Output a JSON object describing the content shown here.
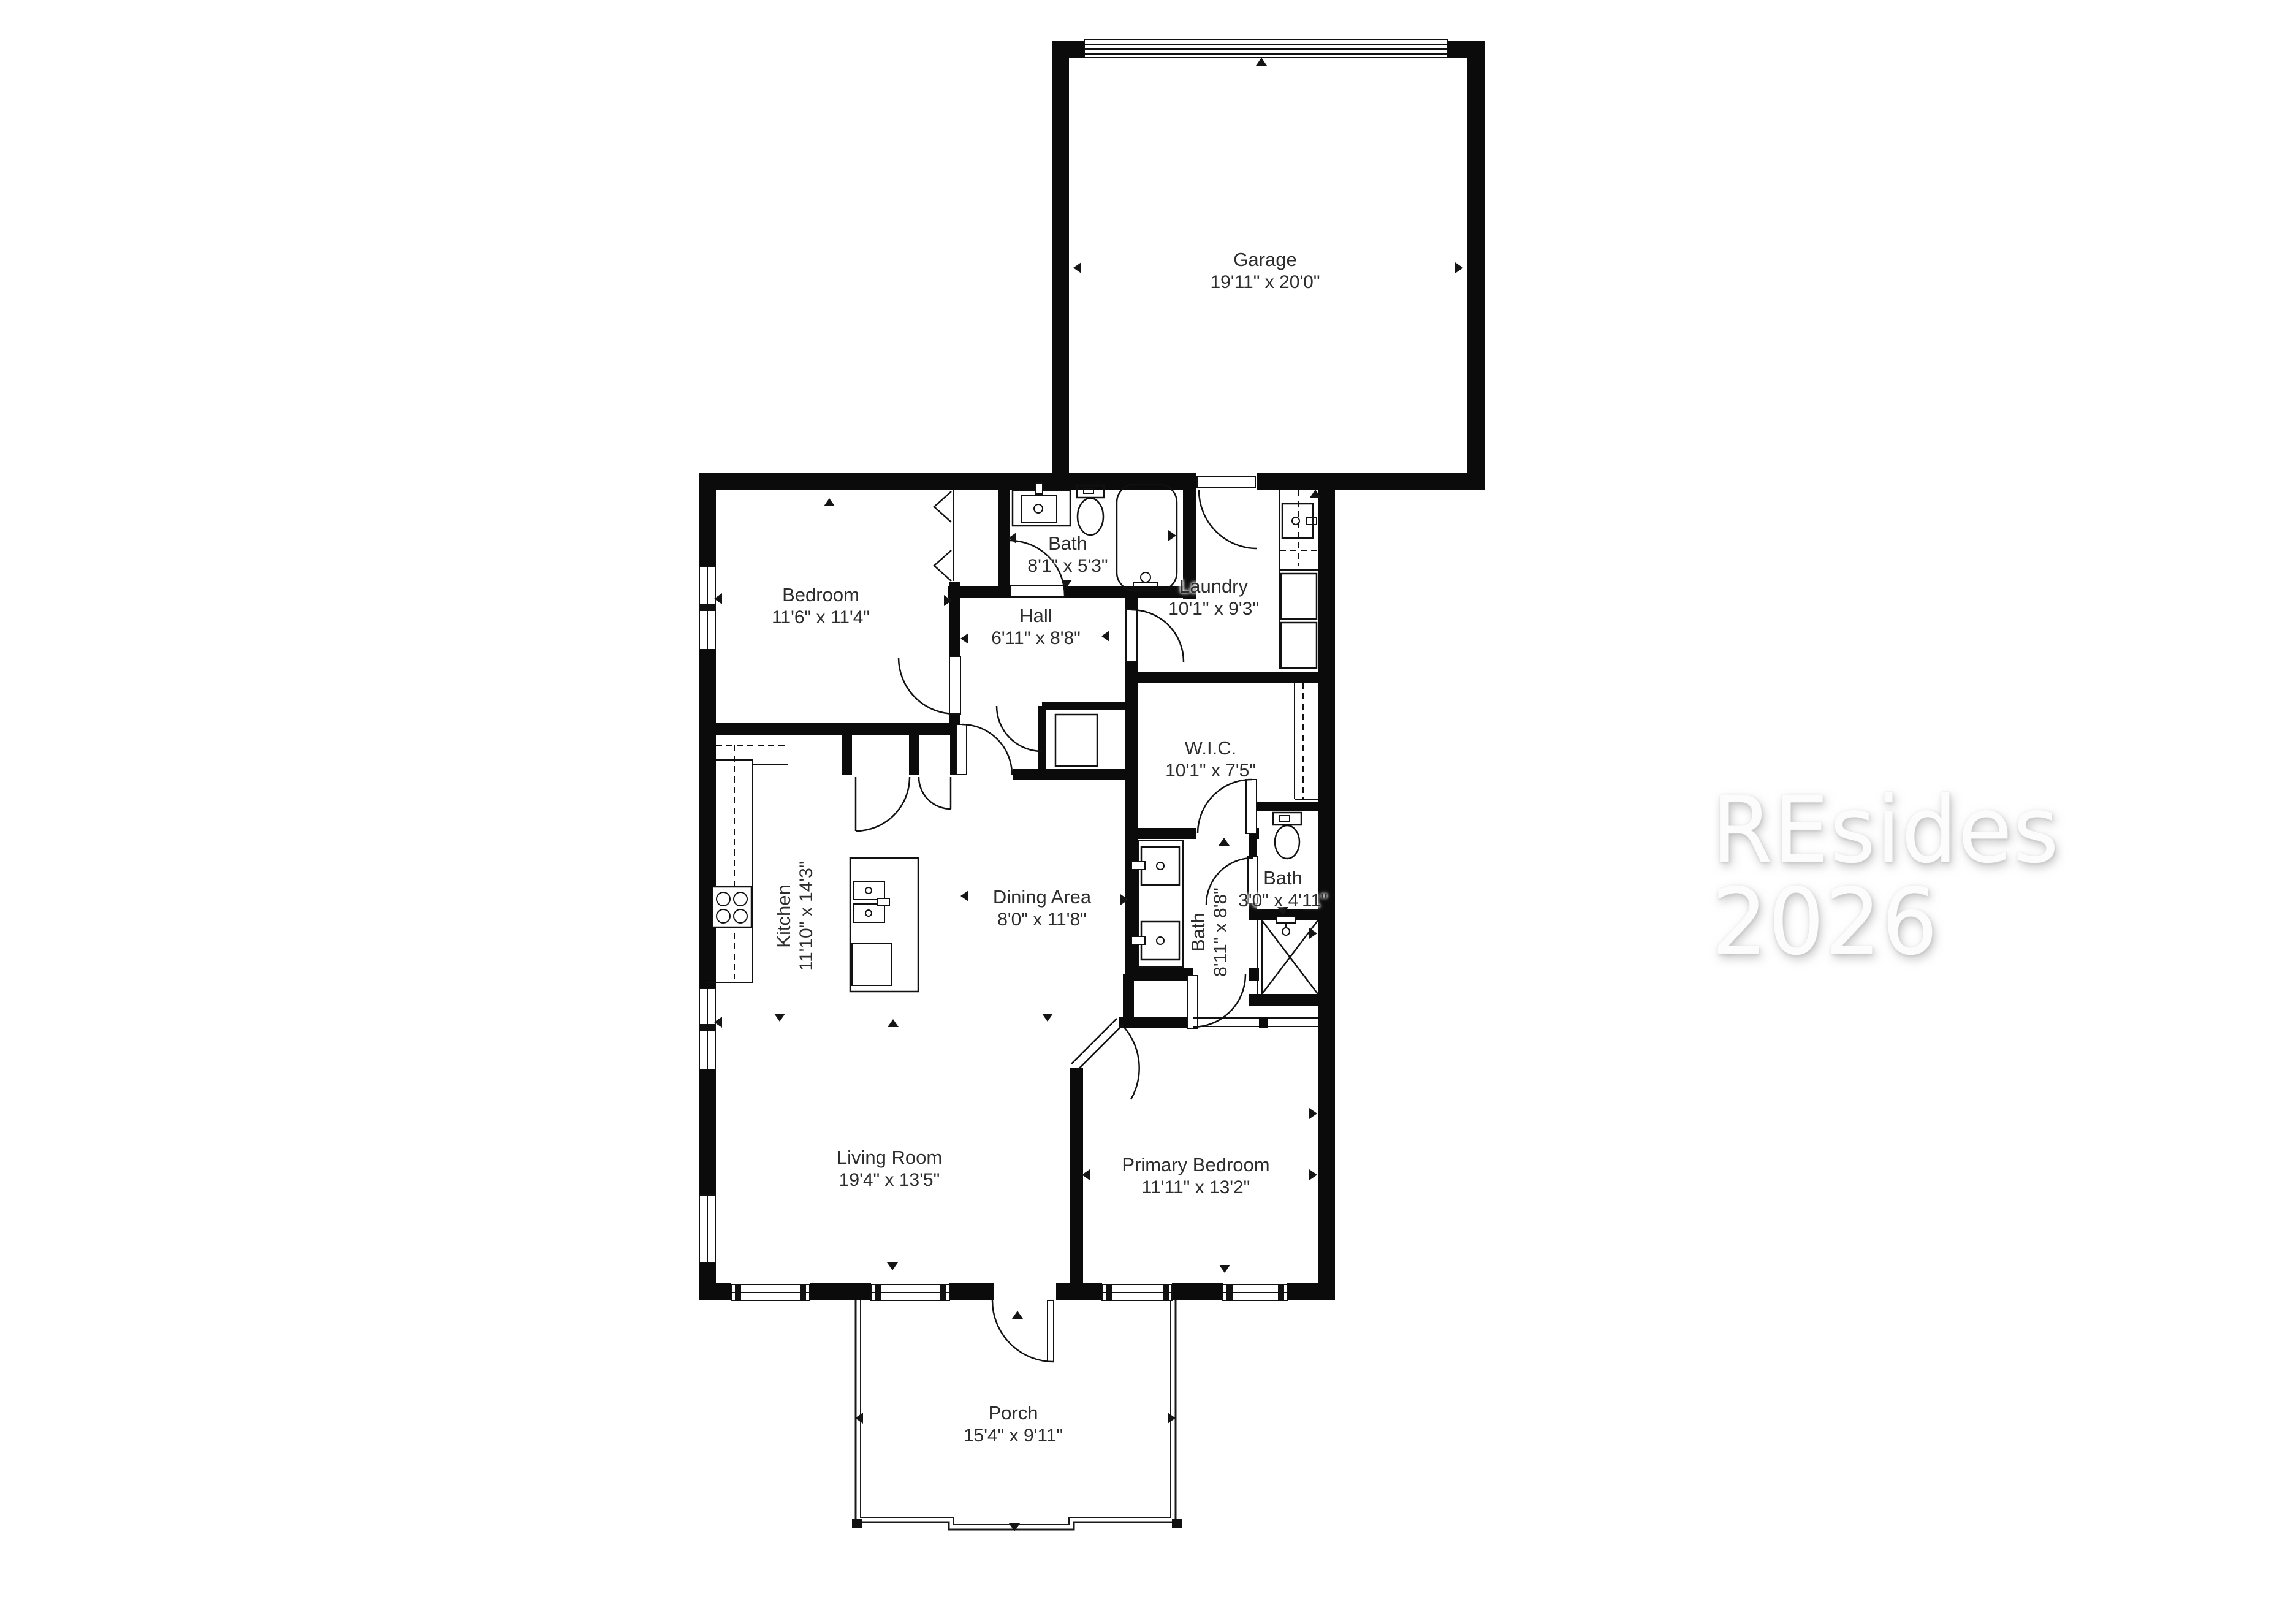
{
  "watermark": {
    "text": "REsides 2026"
  },
  "rooms": {
    "garage": {
      "name": "Garage",
      "dims": "19'11\" x 20'0\""
    },
    "bedroom": {
      "name": "Bedroom",
      "dims": "11'6\" x 11'4\""
    },
    "bath_hall": {
      "name": "Bath",
      "dims": "8'1\" x 5'3\""
    },
    "hall": {
      "name": "Hall",
      "dims": "6'11\" x 8'8\""
    },
    "laundry": {
      "name": "Laundry",
      "dims": "10'1\" x 9'3\""
    },
    "wic": {
      "name": "W.I.C.",
      "dims": "10'1\" x 7'5\""
    },
    "kitchen": {
      "name": "Kitchen",
      "dims": "11'10\" x 14'3\""
    },
    "dining": {
      "name": "Dining Area",
      "dims": "8'0\" x 11'8\""
    },
    "bath_primary": {
      "name": "Bath",
      "dims": "8'11\" x 8'8\""
    },
    "bath_small": {
      "name": "Bath",
      "dims": "3'0\" x 4'11\""
    },
    "living": {
      "name": "Living Room",
      "dims": "19'4\" x 13'5\""
    },
    "primary_bedroom": {
      "name": "Primary Bedroom",
      "dims": "11'11\" x 13'2\""
    },
    "porch": {
      "name": "Porch",
      "dims": "15'4\" x 9'11\""
    }
  },
  "colors": {
    "wall": "#0b0b0b",
    "background": "#ffffff",
    "label_text": "#2d2d2d",
    "watermark": "#fcfcfc"
  }
}
